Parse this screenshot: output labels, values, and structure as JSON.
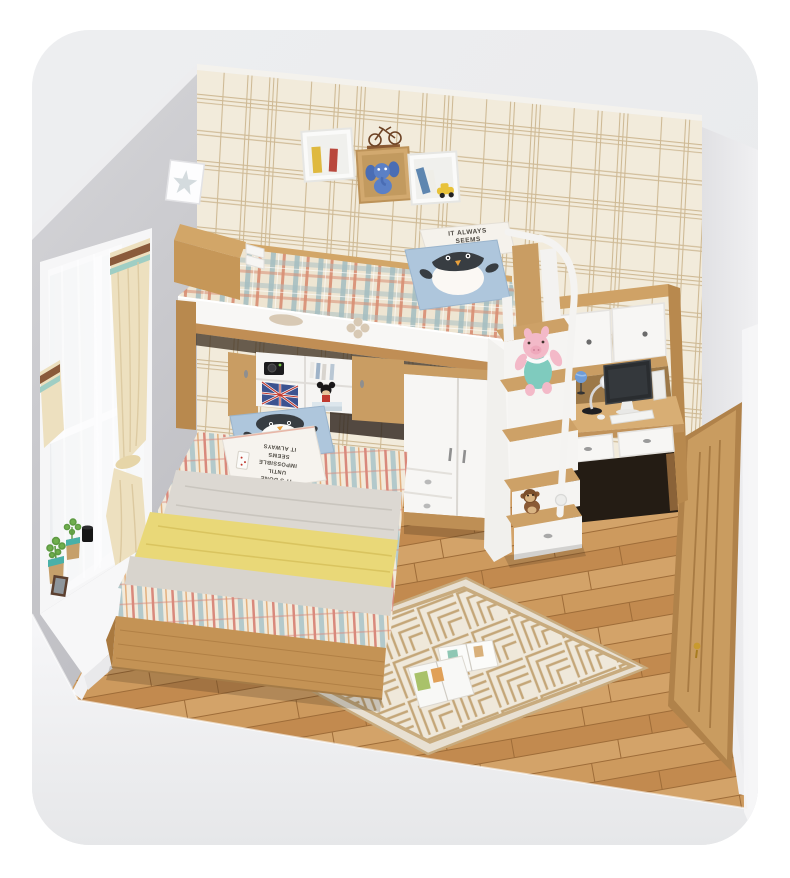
{
  "image": {
    "type": "3D furniture product render",
    "subject": "Children's bedroom with loft bed combination set: upper bunk with guard rail, storage staircase with plush toys, wardrobe, lower bed, corner desk with hutch and computer, wall cube shelves, window with curtains, wooden door and geometric rug"
  },
  "texts": {
    "pillow_quote_upper": [
      "IT ALWAYS",
      "SEEMS",
      "IMPOSSIBLE"
    ],
    "pillow_quote_lower": [
      "IT ALWAYS",
      "SEEMS",
      "IMPOSSIBLE",
      "UNTIL",
      "IT'S DONE"
    ]
  },
  "palette": {
    "page_bg": "#ffffff",
    "card_bg": "#ebecee",
    "left_wall": "#c6c6ca",
    "wallpaper_base": "#f2ebdb",
    "wallpaper_line": "#c6ac82",
    "wood": "#c99d63",
    "wood_dark": "#b3854e",
    "wood_light": "#d8ae74",
    "white_furniture": "#f7f6f4",
    "floor_wood": "#c89356",
    "rug_base": "#efe8da",
    "rug_line": "#c4a678",
    "plaid_teal": "#a3bdc1",
    "plaid_red": "#d98e72",
    "pillow_blue": "#aec6dc",
    "blanket_yellow": "#e9d878",
    "sheet_grey": "#dcd8d2",
    "curtain_cream": "#ede0bf",
    "curtain_stripe_brown": "#8a5a3b",
    "curtain_stripe_teal": "#9fcec4",
    "door_wood": "#c99c60",
    "pig_pink": "#f3b9c8",
    "pig_teal": "#7fcbbe",
    "handle_gold": "#c99a2e"
  }
}
